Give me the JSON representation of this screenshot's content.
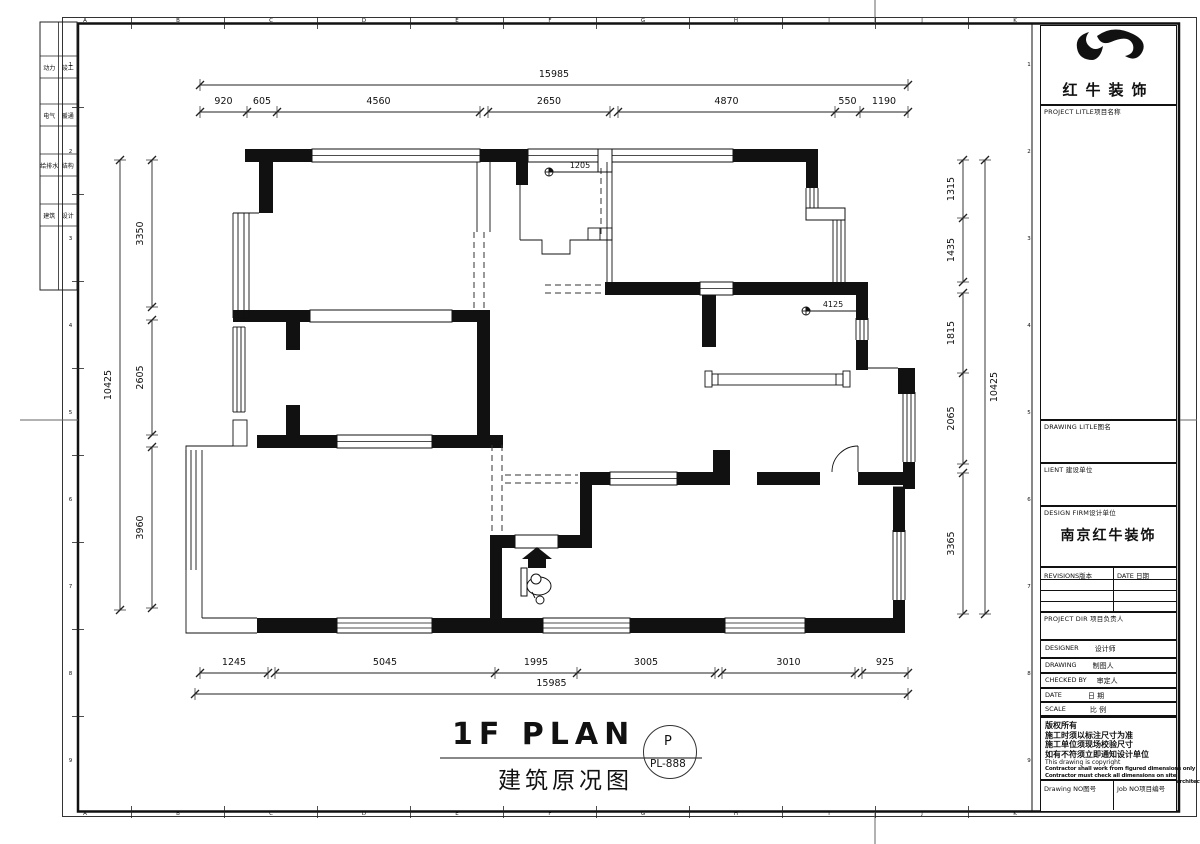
{
  "sheet": {
    "grid_letters": [
      "A",
      "B",
      "C",
      "D",
      "E",
      "F",
      "G",
      "H",
      "I",
      "J",
      "K"
    ],
    "grid_numbers": [
      "1",
      "2",
      "3",
      "4",
      "5",
      "6",
      "7",
      "8",
      "9"
    ],
    "signoff_cells": [
      {
        "left": "动力",
        "right": "竣工"
      },
      {
        "left": "电气",
        "right": "暖通"
      },
      {
        "left": "给排水",
        "right": "结构"
      },
      {
        "left": "建筑",
        "right": "设计"
      }
    ]
  },
  "dimensions": {
    "top": {
      "total": "15985",
      "segments": [
        "920",
        "605",
        "4560",
        "2650",
        "4870",
        "550",
        "1190"
      ]
    },
    "bottom": {
      "total": "15985",
      "segments": [
        "1245",
        "5045",
        "1995",
        "3005",
        "3010",
        "925"
      ]
    },
    "left": {
      "total": "10425",
      "segments": [
        "3350",
        "2605",
        "3960"
      ]
    },
    "right": {
      "total": "10425",
      "segments": [
        "1315",
        "1435",
        "1815",
        "2065",
        "3365"
      ]
    }
  },
  "plan": {
    "annotations": [
      {
        "label": "1205"
      },
      {
        "label": "4125"
      }
    ]
  },
  "drawing_title": {
    "main": "1F PLAN",
    "sub": "建筑原况图",
    "badge_letter": "P",
    "badge_number": "PL-888"
  },
  "title_block": {
    "company": "红牛装饰",
    "project_title_label": "PROJECT LITLE项目名称",
    "drawing_title_label": "DRAWING LITLE图名",
    "client_label": "LIENT 建设单位",
    "design_firm_label": "DESIGN FIRM设计单位",
    "design_firm_value": "南京红牛装饰",
    "revisions_label": "REVISIONS版本",
    "revisions_date_label": "DATE 日期",
    "project_dir_label": "PROJECT DIR 项目负责人",
    "designer_label": "DESIGNER",
    "designer_cn": "设计师",
    "drawing_label": "DRAWING",
    "drawing_cn": "制图人",
    "checked_label": "CHECKED BY",
    "checked_cn": "审定人",
    "date_label": "DATE",
    "date_cn": "日 期",
    "scale_label": "SCALE",
    "scale_cn": "比 例",
    "copyright_lines": [
      "版权所有",
      "施工时须以标注尺寸为准",
      "施工单位须现场校验尺寸",
      "如有不符须立即通知设计单位",
      "This drawing is copyright",
      "Contractor shall work from figured dimensions only",
      "Contractor must check all dimensions on site",
      "Deviations must be reported immediately to architects"
    ],
    "drawing_no_label": "Drawing NO图号",
    "job_no_label": "Job NO项目编号"
  }
}
